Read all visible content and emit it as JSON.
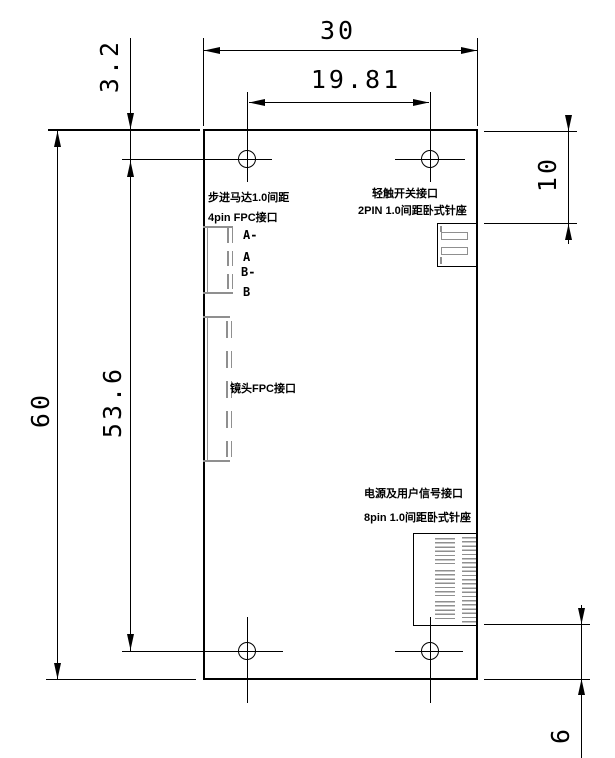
{
  "dimensions": {
    "board_width": "30",
    "hole_span_width": "19.81",
    "top_hole_offset": "3.2",
    "board_height": "60",
    "hole_span_height": "53.6",
    "switch_offset": "10",
    "power_offset": "6"
  },
  "labels": {
    "stepper_line1": "步进马达1.0间距",
    "stepper_line2": "4pin FPC接口",
    "pins": [
      "A-",
      "A",
      "B-",
      "B"
    ],
    "switch_line1": "轻触开关接口",
    "switch_line2": "2PIN 1.0间距卧式针座",
    "lens": "镜头FPC接口",
    "power_line1": "电源及用户信号接口",
    "power_line2": "8pin 1.0间距卧式针座"
  },
  "colors": {
    "line": "#000000",
    "connector_gray": "#8f8f8f",
    "background": "#ffffff"
  }
}
